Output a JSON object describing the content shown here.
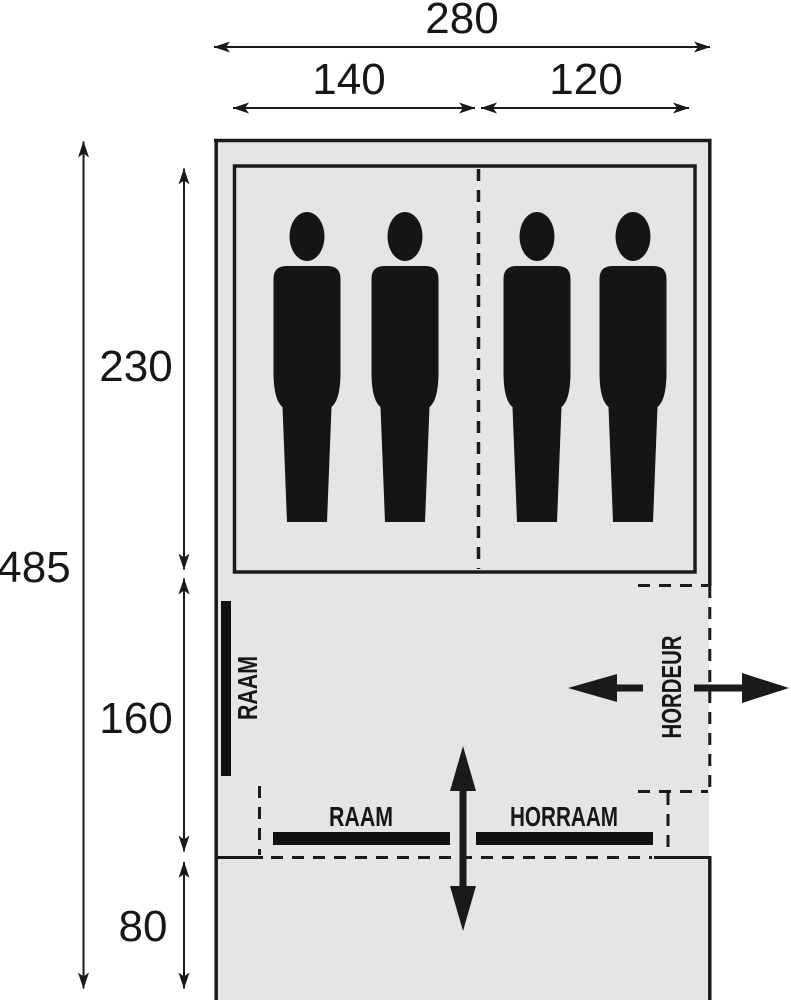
{
  "diagram": {
    "kind": "tent-floorplan",
    "dims": {
      "width_total": "280",
      "width_left": "140",
      "width_right": "120",
      "depth_total": "485",
      "depth_sleeping": "230",
      "depth_living": "160",
      "depth_porch": "80"
    },
    "labels": {
      "side_window": "RAAM",
      "front_window": "RAAM",
      "screen_window": "HORRAAM",
      "screen_door": "HORDEUR"
    },
    "colors": {
      "line": "#1a1a1d",
      "text": "#17171a",
      "tent_fill": "#e5e5e7",
      "cabin_fill": "#f7f7f8",
      "figure": "#151518",
      "bar": "#111114",
      "background": "#ffffff"
    },
    "icons": {
      "person": "person-silhouette-icon",
      "vent_arrow": "up-down-arrow-icon",
      "door_in_arrow": "left-arrow-icon",
      "door_out_arrow": "right-arrow-icon"
    },
    "person_count": 4
  }
}
